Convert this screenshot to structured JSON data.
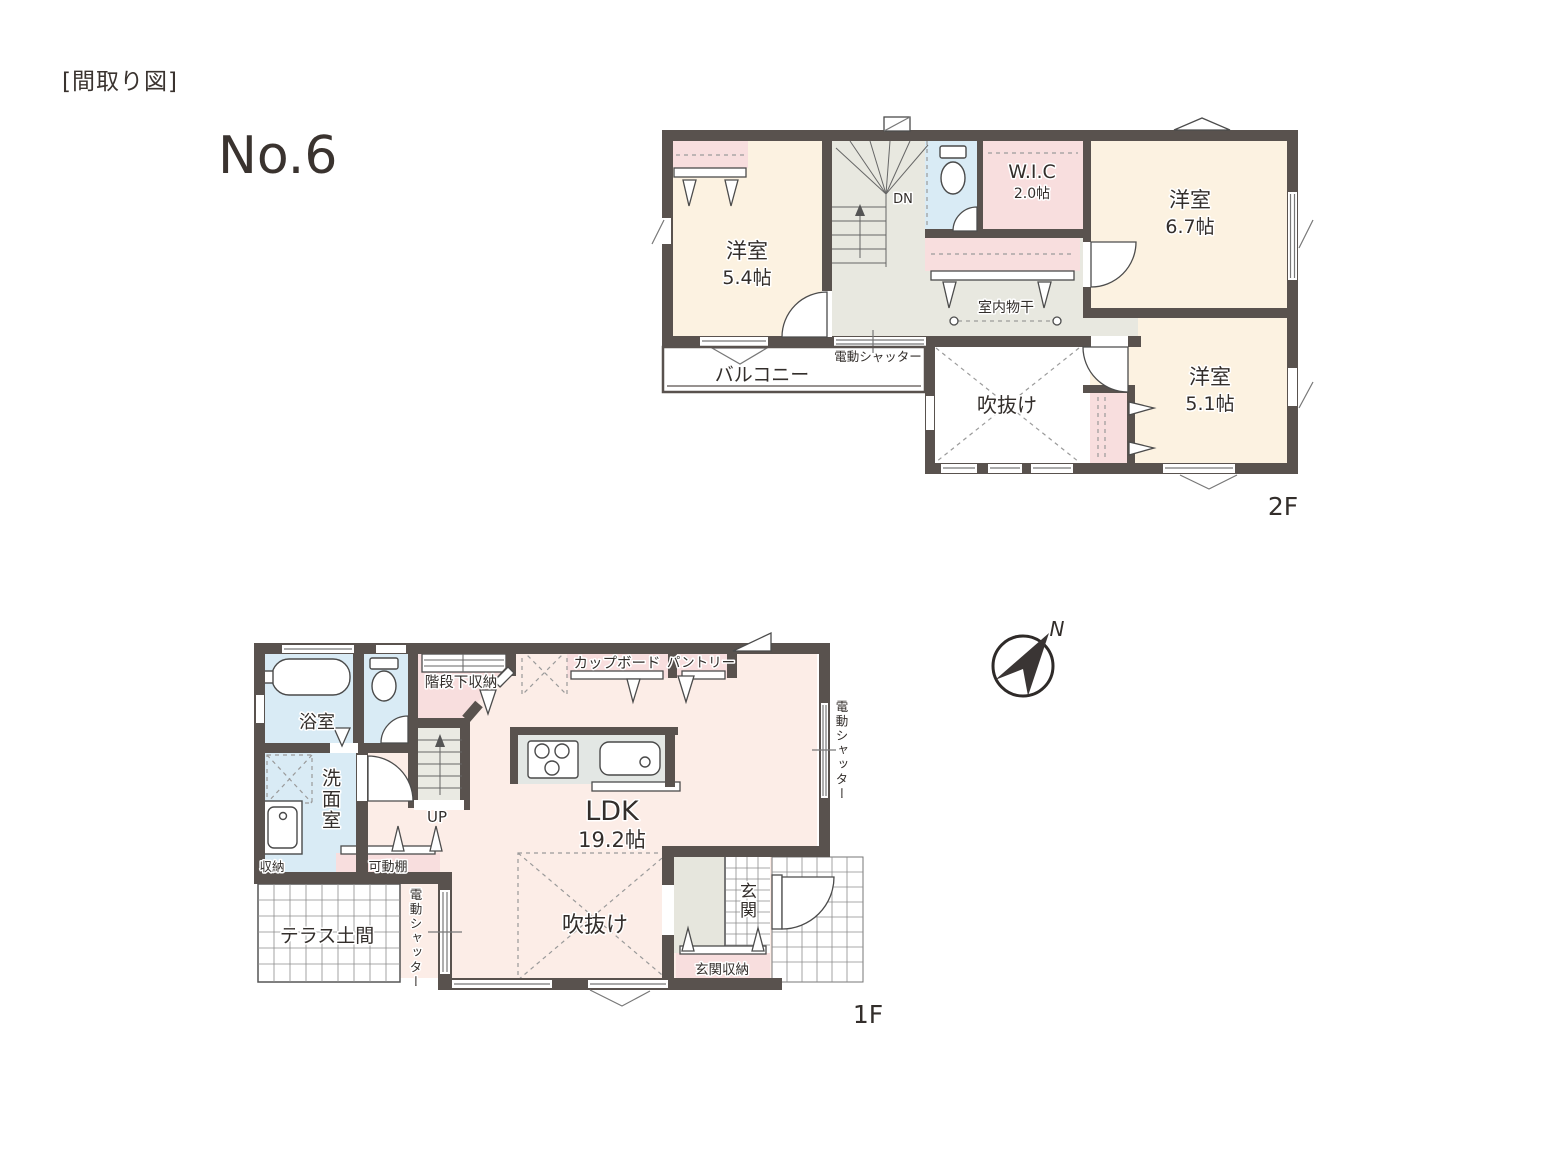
{
  "header": {
    "title": "[間取り図]",
    "plan_number": "No.6"
  },
  "compass": {
    "north": "N"
  },
  "floor2": {
    "tag": "2F",
    "rooms": {
      "west": {
        "name": "洋室",
        "size": "5.4帖"
      },
      "east": {
        "name": "洋室",
        "size": "6.7帖"
      },
      "southeast": {
        "name": "洋室",
        "size": "5.1帖"
      },
      "wic": {
        "name": "W.I.C",
        "size": "2.0帖"
      }
    },
    "labels": {
      "balcony": "バルコニー",
      "void": "吹抜け",
      "indoor_drying": "室内物干",
      "electric_shutter": "電動シャッター",
      "down": "DN"
    }
  },
  "floor1": {
    "tag": "1F",
    "rooms": {
      "ldk": {
        "name": "LDK",
        "size": "19.2帖"
      },
      "bath": "浴室",
      "washroom": "洗面室",
      "entrance": "玄関"
    },
    "labels": {
      "under_stair_storage": "階段下収納",
      "cupboard": "カップボード",
      "pantry": "パントリー",
      "storage": "収納",
      "movable_shelf": "可動棚",
      "terrace": "テラス土間",
      "void": "吹抜け",
      "entrance_storage": "玄関収納",
      "up": "UP",
      "electric_shutter_east": "電動シャッター",
      "electric_shutter_terrace": "電動シャッター"
    }
  },
  "colors": {
    "wall": "#59524E",
    "room_cream": "#FCF2E1",
    "closet_pink": "#F8DEDE",
    "water_blue": "#D9EBF5",
    "hall_gray": "#E8E8E0",
    "ldk_pink": "#FCEDE7",
    "counter_gray": "#E3E7E4",
    "tile_white": "#FFFFFF",
    "text": "#332E2B"
  }
}
